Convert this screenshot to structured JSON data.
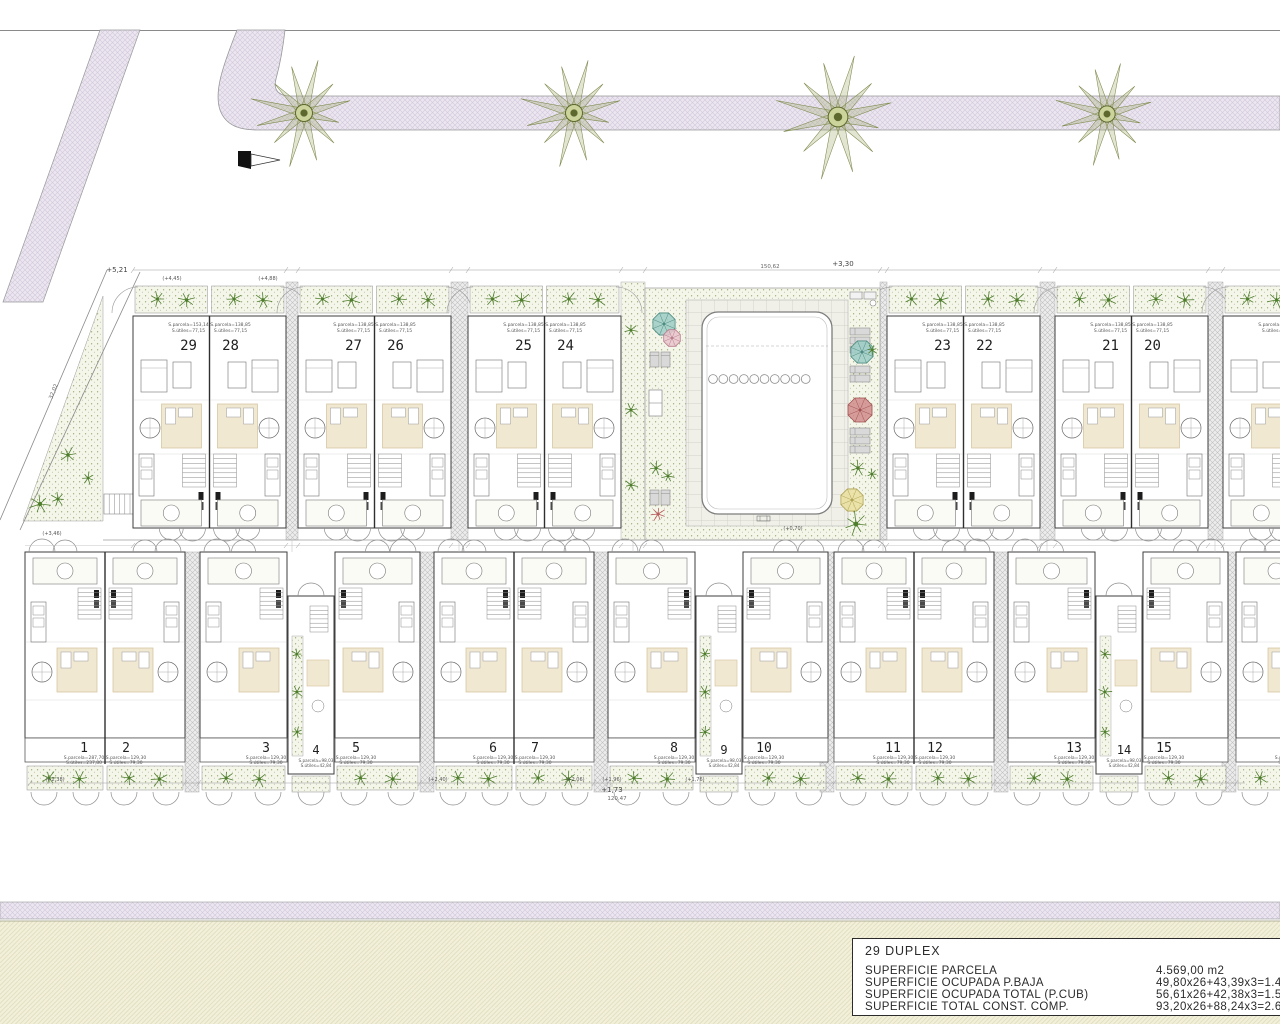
{
  "title_block": {
    "title": "29 DUPLEX",
    "rows": [
      {
        "label": "SUPERFICIE PARCELA",
        "value": "4.569,00 m2"
      },
      {
        "label": "SUPERFICIE OCUPADA P.BAJA",
        "value": "49,80x26+43,39x3=1.4"
      },
      {
        "label": "SUPERFICIE OCUPADA TOTAL (P.CUB)",
        "value": "56,61x26+42,38x3=1.5"
      },
      {
        "label": "SUPERFICIE TOTAL CONST. COMP.",
        "value": "93,20x26+88,24x3=2.6"
      }
    ]
  },
  "annotations": {
    "plus521": "+5,21",
    "plus330": "+3,30",
    "top_total": "150,62",
    "diag": "32,02",
    "lvl1": "(+4,45)",
    "lvl2": "(+4,88)",
    "lvl3": "(+3,46)",
    "pool": "(+0,70)",
    "bottom": [
      "(+2,38)",
      "(+2,40)",
      "(+2,06)",
      "(+1,96)",
      "(+1,76)"
    ],
    "plus173": "+1,73",
    "bottom_total": "120,47"
  },
  "top_units": [
    {
      "num": "29",
      "a1": "S.parcela=153,14",
      "a2": "S.útiles=77,15"
    },
    {
      "num": "28",
      "a1": "S.parcela=138,85",
      "a2": "S.útiles=77,15"
    },
    {
      "num": "27",
      "a1": "S.parcela=138,85",
      "a2": "S.útiles=77,15"
    },
    {
      "num": "26",
      "a1": "S.parcela=138,85",
      "a2": "S.útiles=77,15"
    },
    {
      "num": "25",
      "a1": "S.parcela=138,85",
      "a2": "S.útiles=77,15"
    },
    {
      "num": "24",
      "a1": "S.parcela=138,85",
      "a2": "S.útiles=77,15"
    },
    {
      "num": "23",
      "a1": "S.parcela=138,85",
      "a2": "S.útiles=77,15"
    },
    {
      "num": "22",
      "a1": "S.parcela=138,85",
      "a2": "S.útiles=77,15"
    },
    {
      "num": "21",
      "a1": "S.parcela=138,85",
      "a2": "S.útiles=77,15"
    },
    {
      "num": "20",
      "a1": "S.parcela=138,85",
      "a2": "S.útiles=77,15"
    },
    {
      "num": "",
      "a1": "S.parcela=138,85",
      "a2": "S.útiles=77,15"
    }
  ],
  "bottom_units": [
    {
      "num": "1",
      "a1": "S.parcela=287,70",
      "a2": "S.útiles=237,80"
    },
    {
      "num": "2",
      "a1": "S.parcela=129,30",
      "a2": "S.útiles=79,30"
    },
    {
      "num": "3",
      "a1": "S.parcela=129,30",
      "a2": "S.útiles=79,30"
    },
    {
      "num": "4",
      "a1": "S.parcela=98,03",
      "a2": "S.útiles=42,84"
    },
    {
      "num": "5",
      "a1": "S.parcela=129,30",
      "a2": "S.útiles=79,30"
    },
    {
      "num": "6",
      "a1": "S.parcela=129,30",
      "a2": "S.útiles=79,30"
    },
    {
      "num": "7",
      "a1": "S.parcela=129,30",
      "a2": "S.útiles=79,30"
    },
    {
      "num": "8",
      "a1": "S.parcela=129,30",
      "a2": "S.útiles=79,30"
    },
    {
      "num": "9",
      "a1": "S.parcela=98,03",
      "a2": "S.útiles=42,84"
    },
    {
      "num": "10",
      "a1": "S.parcela=129,30",
      "a2": "S.útiles=79,30"
    },
    {
      "num": "11",
      "a1": "S.parcela=129,30",
      "a2": "S.útiles=79,30"
    },
    {
      "num": "12",
      "a1": "S.parcela=129,30",
      "a2": "S.útiles=79,30"
    },
    {
      "num": "13",
      "a1": "S.parcela=129,30",
      "a2": "S.útiles=79,30"
    },
    {
      "num": "14",
      "a1": "S.parcela=98,03",
      "a2": "S.útiles=42,84"
    },
    {
      "num": "15",
      "a1": "S.parcela=129,30",
      "a2": "S.útiles=79,30"
    },
    {
      "num": "",
      "a1": "S.parcela=129,30",
      "a2": "S.útiles=79,30"
    }
  ]
}
